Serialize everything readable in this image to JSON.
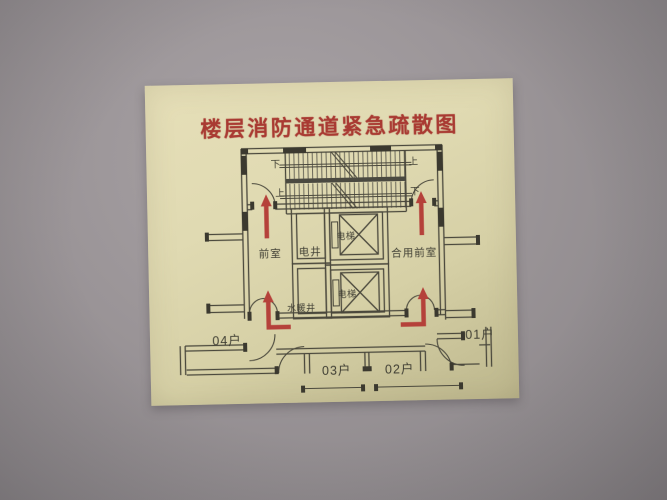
{
  "photo": {
    "wall_color": "#9b9598"
  },
  "sign": {
    "title": "楼层消防通道紧急疏散图",
    "title_color": "#a93a32",
    "background_color": "#ded8ae",
    "floor_plan": {
      "line_color": "#4a483c",
      "arrow_color": "#b5413a",
      "stairs": {
        "upper_left": "下",
        "upper_right": "上",
        "lower_left": "上",
        "lower_right": "下"
      },
      "rooms": {
        "front_room": "前室",
        "electrical_shaft": "电井",
        "elevator_upper": "电梯",
        "elevator_lower": "电梯",
        "shared_front_room": "合用前室",
        "plumbing_shaft": "水暖井"
      },
      "units": {
        "unit_04": "04户",
        "unit_01": "01户",
        "unit_03": "03户",
        "unit_02": "02户"
      }
    }
  }
}
